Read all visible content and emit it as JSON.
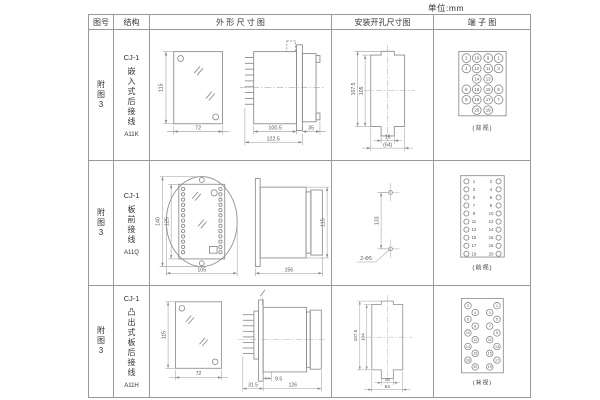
{
  "page": {
    "unit_label": "单位:mm"
  },
  "header": {
    "figure_no": "图号",
    "structure": "结构",
    "outline": "外 形 尺 寸 图",
    "install": "安装开孔尺寸图",
    "terminal": "端 子 图"
  },
  "rows": [
    {
      "figure_no": "附图3",
      "model": "CJ-1",
      "desc": "嵌入式后接线",
      "code": "A11K",
      "outline": {
        "front_h": "115",
        "front_w": "72",
        "body_len": "100.5",
        "total_len": "122.5",
        "rear_len": "35"
      },
      "install": {
        "outer_h": "107.5",
        "inner_h": "105",
        "slot_w": "16",
        "cutout_w": "(64)"
      },
      "terminal": {
        "view_label": "(背视)",
        "grid": [
          [
            "2",
            "10",
            "9",
            "1"
          ],
          [
            "4",
            "12",
            "11",
            "3"
          ],
          [
            "",
            "14",
            "13",
            ""
          ],
          [
            "6",
            "16",
            "15",
            "5"
          ],
          [
            "8",
            "18",
            "17",
            "7"
          ],
          [
            "",
            "20",
            "19",
            ""
          ]
        ]
      }
    },
    {
      "figure_no": "附图3",
      "model": "CJ-1",
      "desc": "板前接线",
      "code": "A11Q",
      "outline": {
        "outer_h": "140",
        "inner_h": "125",
        "width": "105",
        "side_len": "156",
        "side_h": "115"
      },
      "install": {
        "hole_dist": "133",
        "hole_label": "2-Φ5"
      },
      "terminal": {
        "view_label": "(前视)",
        "left_nums": [
          "1",
          "3",
          "5",
          "7",
          "9",
          "11",
          "13",
          "15",
          "17",
          "19"
        ],
        "right_nums": [
          "2",
          "4",
          "6",
          "8",
          "10",
          "12",
          "14",
          "16",
          "18",
          "20"
        ]
      }
    },
    {
      "figure_no": "附图3",
      "model": "CJ-1",
      "desc": "凸出式板后接线",
      "code": "A11H",
      "outline": {
        "front_h": "115",
        "front_w": "72",
        "pin_len": "9.5",
        "seg_len": "31.5",
        "body_len": "126"
      },
      "install": {
        "outer_h": "107.5",
        "inner_h": "104",
        "slot_w": "16",
        "cutout_w": "64"
      },
      "terminal": {
        "view_label": "(背视)",
        "left_outer": [
          "2",
          "6",
          "10",
          "14",
          "18"
        ],
        "left_inner": [
          "4",
          "8",
          "12",
          "16",
          "20"
        ],
        "right_inner": [
          "3",
          "7",
          "11",
          "15",
          "19"
        ],
        "right_outer": [
          "1",
          "5",
          "9",
          "13",
          "17"
        ]
      }
    }
  ]
}
